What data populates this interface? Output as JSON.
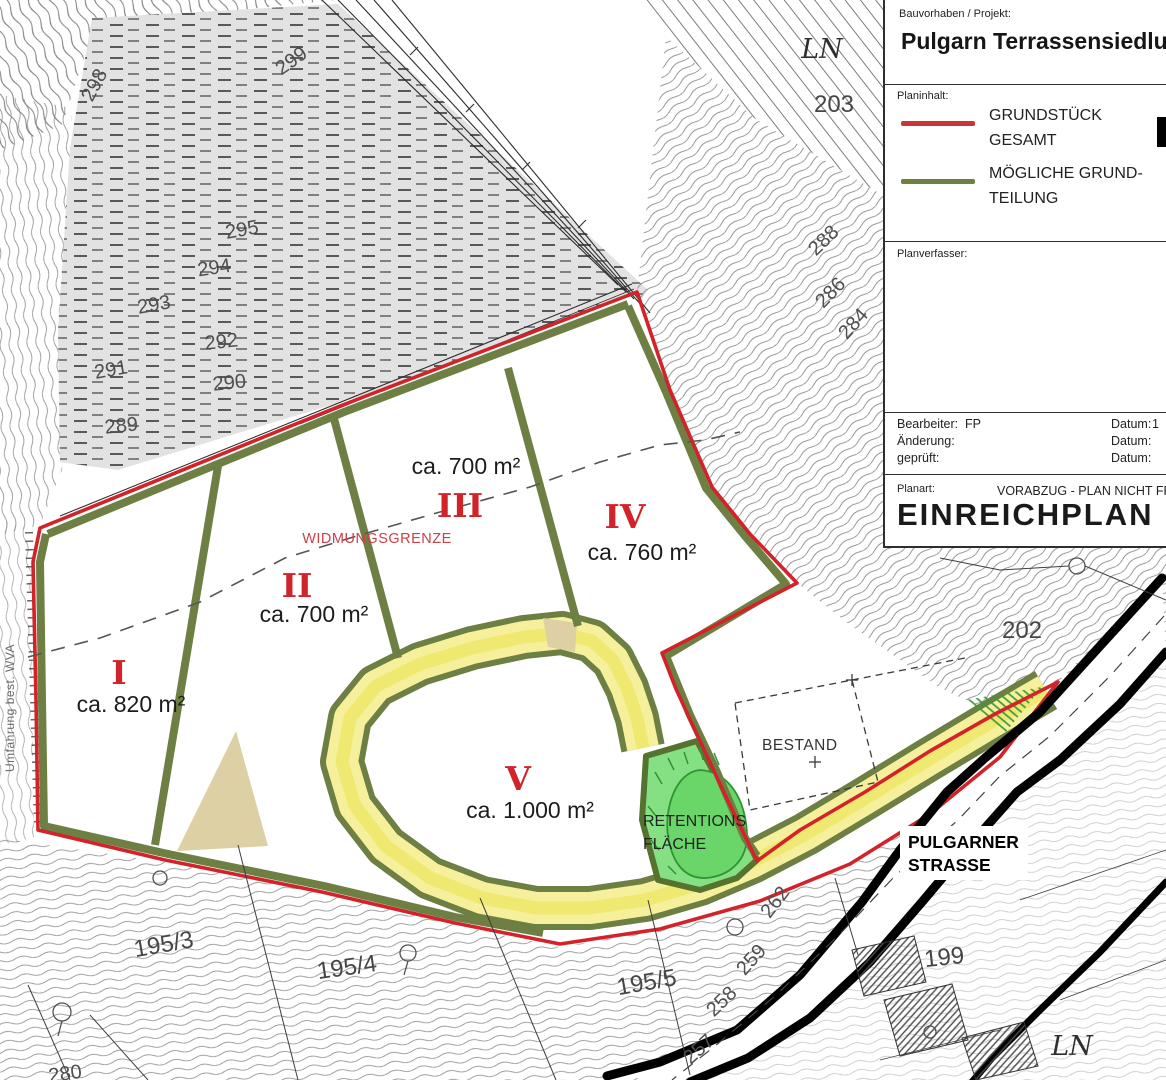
{
  "title_block": {
    "project_label": "Bauvorhaben / Projekt:",
    "project_name": "Pulgarn Terrassensiedlung",
    "content_label": "Planinhalt:",
    "legend": [
      {
        "color": "#c8363b",
        "line1": "GRUNDSTÜCK",
        "line2": "GESAMT"
      },
      {
        "color": "#6d7f42",
        "line1": "MÖGLICHE GRUND-",
        "line2": "TEILUNG"
      }
    ],
    "author_label": "Planverfasser:",
    "meta": [
      {
        "label": "Bearbeiter:",
        "value": "FP",
        "date_label": "Datum:",
        "date_value": "1"
      },
      {
        "label": "Änderung:",
        "value": "",
        "date_label": "Datum:",
        "date_value": ""
      },
      {
        "label": "geprüft:",
        "value": "",
        "date_label": "Datum:",
        "date_value": ""
      }
    ],
    "plantype_label": "Planart:",
    "release_note": "VORABZUG - PLAN NICHT FREIGE",
    "plan_type": "EINREICHPLAN"
  },
  "map": {
    "plots": [
      {
        "numeral": "I",
        "area": "ca. 820 m²"
      },
      {
        "numeral": "II",
        "area": "ca. 700 m²"
      },
      {
        "numeral": "III",
        "area": "ca. 700 m²"
      },
      {
        "numeral": "IV",
        "area": "ca. 760 m²"
      },
      {
        "numeral": "V",
        "area": "ca. 1.000 m²"
      }
    ],
    "annotations": {
      "widmungsgrenze": "WIDMUNGSGRENZE",
      "retention_line1": "RETENTIONS",
      "retention_line2": "FLÄCHE",
      "bestand": "BESTAND",
      "street_line1": "PULGARNER",
      "street_line2": "STRASSE",
      "corner_mark_top": "LN",
      "corner_mark_bottom": "LN",
      "side_note": "Umfahrung best. WVA"
    },
    "parcel_numbers": {
      "p203": "203",
      "p202": "202",
      "p199": "199",
      "p195_3": "195/3",
      "p195_4": "195/4",
      "p195_5": "195/5"
    },
    "contour_labels": {
      "c298": "298",
      "c299": "299",
      "c295": "295",
      "c294": "294",
      "c293": "293",
      "c292": "292",
      "c291": "291",
      "c290": "290",
      "c289": "289",
      "c288": "288",
      "c286": "286",
      "c284": "284",
      "c280": "280",
      "c262": "262",
      "c259": "259",
      "c258": "258",
      "c257": "257"
    },
    "colors": {
      "boundary_red": "#d2232a",
      "division_green": "#6d7f42",
      "road_yellow": "#f6f09c",
      "retention_green": "#84e083",
      "street_black": "#000000"
    }
  }
}
